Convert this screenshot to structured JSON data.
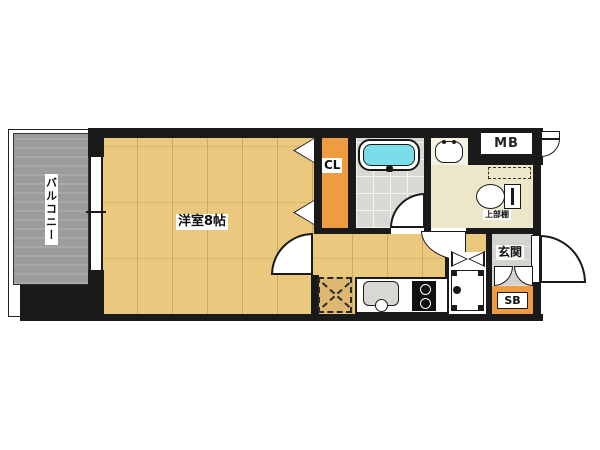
{
  "floor_plan": {
    "rooms": {
      "balcony": {
        "label": "バルコニー"
      },
      "western_room": {
        "label": "洋室8帖"
      },
      "closet": {
        "label": "CL"
      },
      "meter_box": {
        "label": "MB"
      },
      "toilet": {
        "shelf_label": "上部棚"
      },
      "entrance": {
        "label": "玄関"
      },
      "shoe_box": {
        "label": "SB"
      }
    },
    "colors": {
      "wall": "#1a1a1a",
      "wood_floor": "#eac87e",
      "accent_orange": "#ef9b42",
      "balcony_gray": "#9c9c9c",
      "bath_tile": "#d9d9d4",
      "toilet_cream": "#ece7cb",
      "entrance_gray": "#d4d4ce",
      "bathtub_cyan": "#7adee9"
    }
  }
}
